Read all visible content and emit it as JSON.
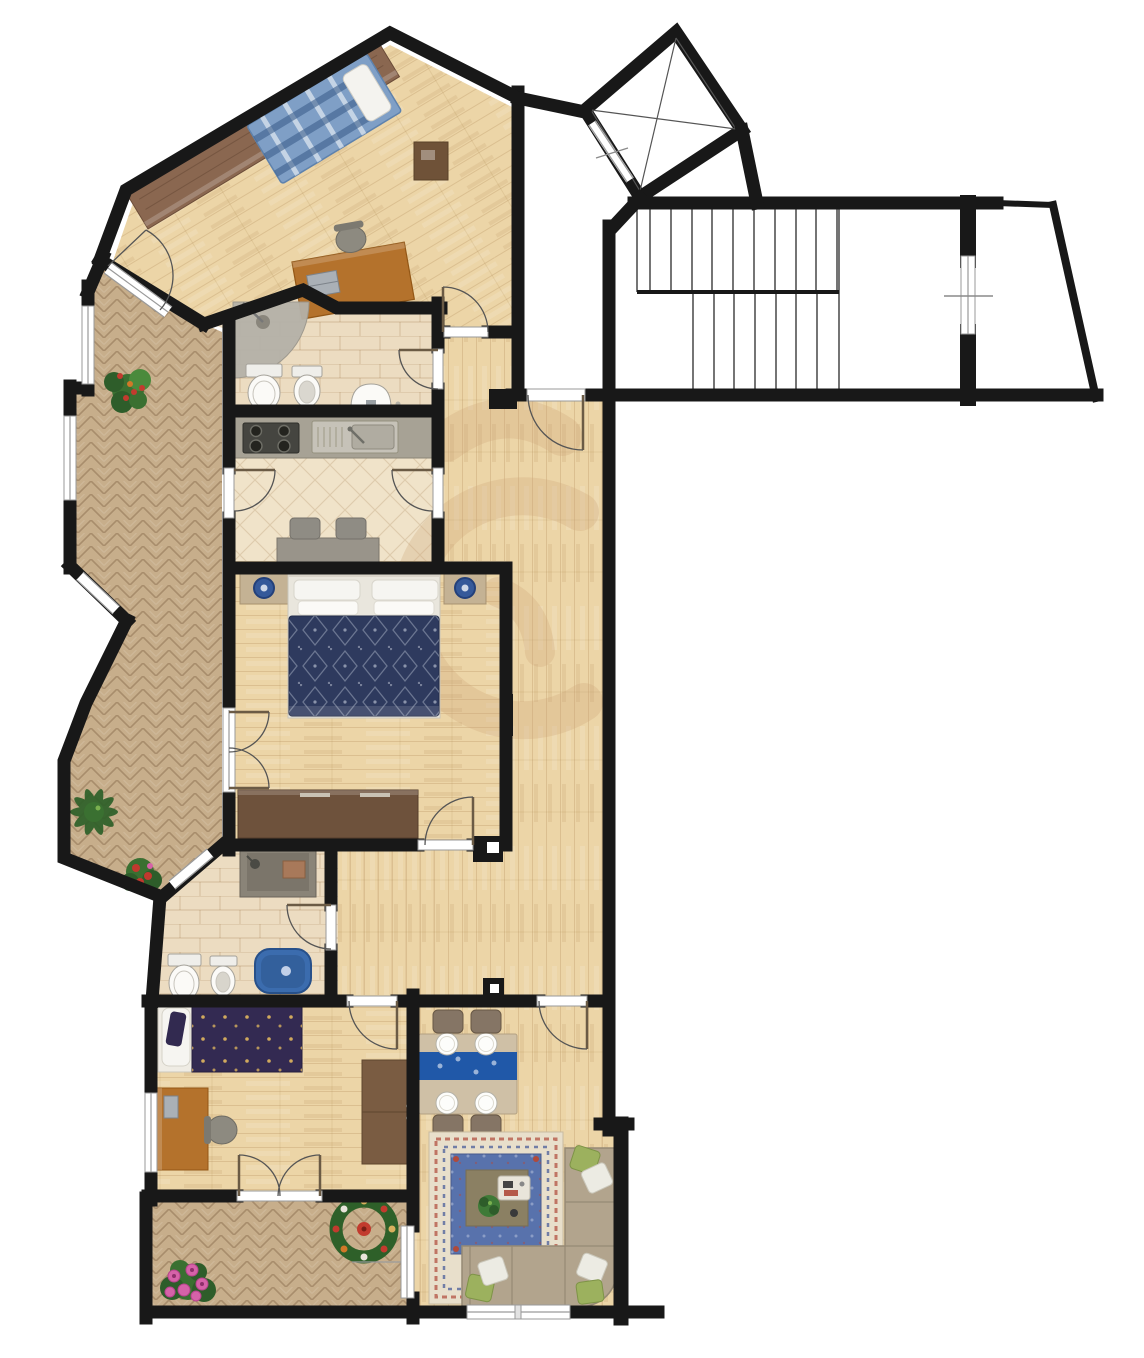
{
  "document": {
    "kind": "apartment-floor-plan",
    "has_text_labels": false
  },
  "palette": {
    "wall": "#181818",
    "white": "#ffffff",
    "wood": "#ecd5a7",
    "tile": "#ecdcc1",
    "kitchenTile": "#f0e3c9",
    "brickPaving": "#c7ae8b",
    "counter": "#a7a295",
    "stove": "#454540",
    "steel": "#c6c2b8",
    "bedPlaid": "#7f9fc6",
    "navyDuvet": "#2e3a5e",
    "purpleDuvet": "#332a52",
    "pillow": "#f6f5f1",
    "walnut": "#8a6750",
    "darkWood": "#6e523c",
    "deskWood": "#b4722c",
    "nightstand": "#c4b294",
    "lampBlue": "#35599a",
    "sofa": "#b2a48d",
    "pillowGreen": "#9cb15e",
    "rugBorder": "#e8dfcb",
    "rugField": "#5872ac",
    "rugCenter": "#8b8063",
    "runnerBlue": "#2058a8",
    "chairBrown": "#857565",
    "chairGray": "#8f8c84",
    "tableGray": "#99948a",
    "tubBlue": "#3b6cae",
    "shower": "#b5b1a8",
    "plant": "#3a7031",
    "plantDark": "#2e5d2a",
    "flowerPink": "#d662a8",
    "flowerRed": "#c23b2e",
    "windowFrame": "#9a9a9a",
    "doorArc": "#555555",
    "doorLeaf": "#6b5b45",
    "watermark": "#cfa87c"
  },
  "rooms": [
    {
      "id": "bedroom-top",
      "floor": "wood"
    },
    {
      "id": "bathroom-top",
      "floor": "tile"
    },
    {
      "id": "kitchen",
      "floor": "diagonal-tile"
    },
    {
      "id": "entry-landing",
      "floor": "wood"
    },
    {
      "id": "corridor",
      "floor": "wood"
    },
    {
      "id": "master-bedroom",
      "floor": "wood"
    },
    {
      "id": "bathroom-lower",
      "floor": "tile"
    },
    {
      "id": "bedroom-lower",
      "floor": "wood"
    },
    {
      "id": "living-dining-room",
      "floor": "wood"
    },
    {
      "id": "balcony-left",
      "floor": "herringbone-brick"
    },
    {
      "id": "balcony-bottom",
      "floor": "herringbone-brick"
    },
    {
      "id": "stairwell",
      "floor": "none"
    }
  ],
  "stairs": {
    "upper_step_lines": 10,
    "lower_step_lines": 8,
    "flights": 2
  },
  "elevator": {
    "shape": "rotated-square-with-cross",
    "door": "sliding"
  },
  "fixtures": {
    "bathroom_top": [
      "shower",
      "toilet",
      "bidet",
      "washbasin"
    ],
    "bathroom_lower": [
      "shower",
      "toilet",
      "bidet",
      "bathtub"
    ],
    "kitchen": [
      "stove-4-burners",
      "sink-unit",
      "counter",
      "table",
      "2-chairs"
    ],
    "dining": {
      "plates": 4,
      "chairs": 4
    },
    "sofa_pillows": 6,
    "plants": 5
  }
}
